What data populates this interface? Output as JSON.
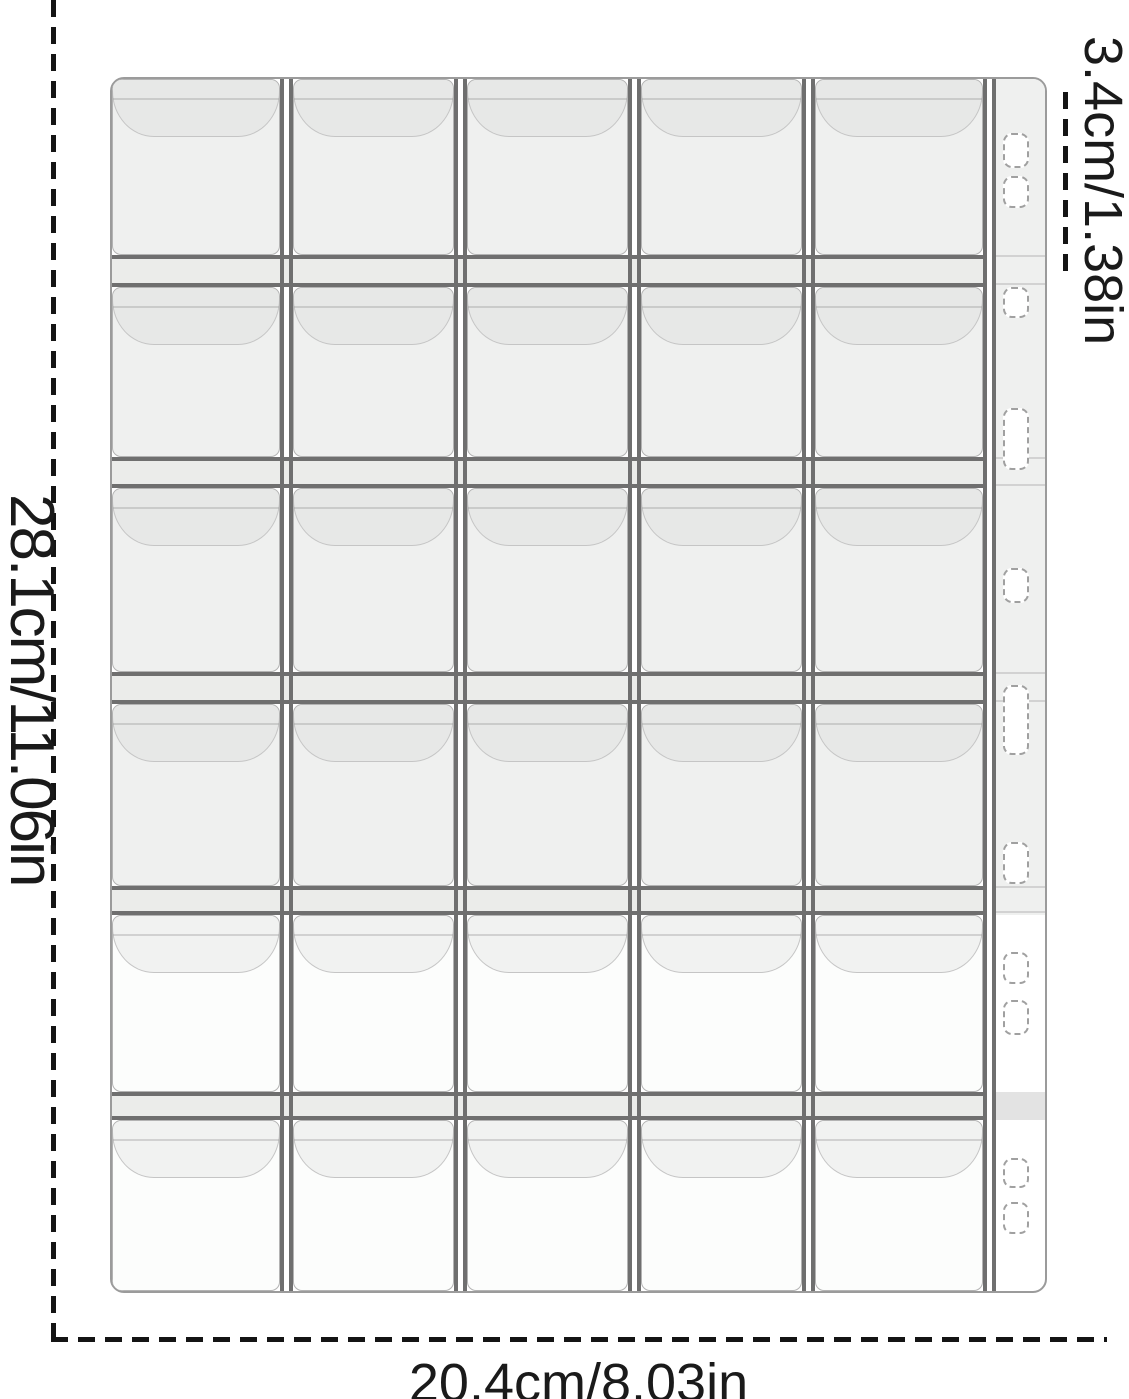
{
  "annotations": {
    "left": "28.1cm/11.06in",
    "bottom": "20.4cm/8.03in",
    "right": "3.4cm/1.38in"
  },
  "sheet": {
    "rows": 6,
    "columns": 5,
    "pockets_total": 30,
    "gray_rows": 4,
    "row_heights": [
      176,
      170,
      184,
      182,
      177,
      171
    ],
    "row_seam_heights": [
      32,
      31,
      32,
      29,
      28
    ],
    "col_widths": [
      168,
      161,
      161,
      161,
      168
    ],
    "col_seam_width": 13,
    "binder_strip": {
      "width": 62,
      "hole_count": 11,
      "gray_section_height": 836,
      "band_top": 1013,
      "band_height": 28,
      "seam_line_tops": [
        176,
        204,
        378,
        405,
        593,
        621,
        807,
        832
      ],
      "holes": [
        {
          "top": 54,
          "height": 35
        },
        {
          "top": 97,
          "height": 32
        },
        {
          "top": 208,
          "height": 31
        },
        {
          "top": 329,
          "height": 62
        },
        {
          "top": 489,
          "height": 35
        },
        {
          "top": 606,
          "height": 70
        },
        {
          "top": 763,
          "height": 42
        },
        {
          "top": 873,
          "height": 32
        },
        {
          "top": 921,
          "height": 35
        },
        {
          "top": 1079,
          "height": 30
        },
        {
          "top": 1123,
          "height": 32
        }
      ]
    },
    "colors": {
      "background": "#ffffff",
      "cell_fill": "#eff0ef",
      "cell_fill_white": "#fcfdfc",
      "flap_fill": "#e7e8e7",
      "flap_fill_white": "#f1f2f1",
      "seam_line": "#6f6f6f",
      "seam_band": "#ebecea",
      "strip_band": "#e3e3e3",
      "sheet_outline": "#9b9b9b",
      "cell_outline": "#b3b3b3",
      "hole_outline": "#a0a0a0",
      "dimension_line": "#141414",
      "text": "#1a1a1a"
    }
  }
}
